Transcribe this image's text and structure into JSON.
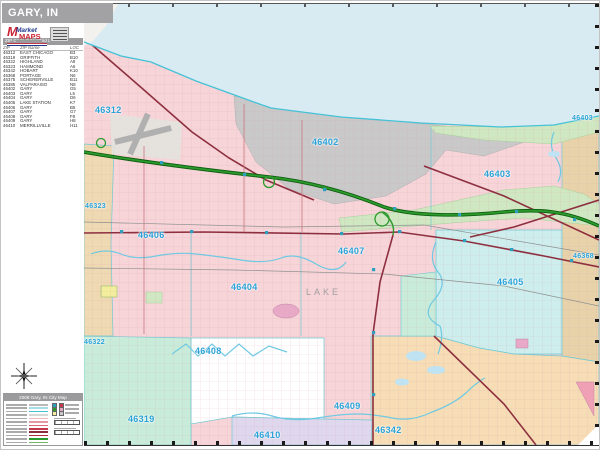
{
  "window": {
    "title": "GARY, IN"
  },
  "logo": {
    "brand_m": "M",
    "brand_top": "Market",
    "brand_bottom": "MAPS"
  },
  "index_table": {
    "header": "ZIP Code Index/Grid Locator",
    "columns": [
      "ZIP Code",
      "ZIP Name",
      "LOC"
    ],
    "rows": [
      [
        "46312",
        "EAST CHICAGO",
        "B3"
      ],
      [
        "46319",
        "GRIFFITH",
        "B10"
      ],
      [
        "46322",
        "HIGHLAND",
        "A8"
      ],
      [
        "46323",
        "HAMMOND",
        "A6"
      ],
      [
        "46342",
        "HOBART",
        "K10"
      ],
      [
        "46368",
        "PORTAGE",
        "N6"
      ],
      [
        "46375",
        "SCHERERVILLE",
        "B11"
      ],
      [
        "46385",
        "VALPARAISO",
        "N8"
      ],
      [
        "46402",
        "GARY",
        "G5"
      ],
      [
        "46403",
        "GARY",
        "L5"
      ],
      [
        "46404",
        "GARY",
        "D6"
      ],
      [
        "46405",
        "LAKE STATION",
        "K7"
      ],
      [
        "46406",
        "GARY",
        "B5"
      ],
      [
        "46407",
        "GARY",
        "G7"
      ],
      [
        "46408",
        "GARY",
        "F8"
      ],
      [
        "46409",
        "GARY",
        "H8"
      ],
      [
        "46410",
        "MERRILLVILLE",
        "H11"
      ]
    ]
  },
  "legend": {
    "title": "2008 Gary, IN City Map",
    "sample_colors": [
      "#b9b9b9",
      "#a6dde8",
      "#49c3d4",
      "#d8d8d8",
      "#f0b8c0",
      "#e59aa6",
      "#d96d7a",
      "#c23a4a",
      "#8e2f3f",
      "#b03040",
      "#2c9b2c",
      "#77b56a"
    ]
  },
  "map": {
    "county_label": "LAKE",
    "label_color": "#2aa2d8",
    "zip_labels": [
      {
        "text": "46312",
        "x": 11,
        "y": 101,
        "size": "lg"
      },
      {
        "text": "46402",
        "x": 228,
        "y": 133,
        "size": "lg"
      },
      {
        "text": "46403",
        "x": 400,
        "y": 165,
        "size": "lg"
      },
      {
        "text": "46403",
        "x": 488,
        "y": 111,
        "size": "sm"
      },
      {
        "text": "46406",
        "x": 54,
        "y": 226,
        "size": "lg"
      },
      {
        "text": "46404",
        "x": 147,
        "y": 278,
        "size": "lg"
      },
      {
        "text": "46407",
        "x": 254,
        "y": 242,
        "size": "lg"
      },
      {
        "text": "46405",
        "x": 413,
        "y": 273,
        "size": "lg"
      },
      {
        "text": "46368",
        "x": 489,
        "y": 249,
        "size": "sm"
      },
      {
        "text": "46409",
        "x": 250,
        "y": 397,
        "size": "lg"
      },
      {
        "text": "46408",
        "x": 111,
        "y": 342,
        "size": "lg"
      },
      {
        "text": "46319",
        "x": 44,
        "y": 410,
        "size": "lg"
      },
      {
        "text": "46410",
        "x": 170,
        "y": 426,
        "size": "lg"
      },
      {
        "text": "46342",
        "x": 291,
        "y": 421,
        "size": "lg"
      },
      {
        "text": "46323",
        "x": 1,
        "y": 199,
        "size": "sm"
      },
      {
        "text": "46322",
        "x": 0,
        "y": 335,
        "size": "sm"
      }
    ],
    "colors": {
      "lake": "#d8ebf3",
      "residential": "#f6d4d8",
      "industrial": "#c9c9ca",
      "park": "#cfe8c2",
      "zone_46405": "#cdeeed",
      "zone_46342": "#f6ddb5",
      "zone_46368": "#e8d2aa",
      "zone_46410": "#ded7ee",
      "zone_46319": "#c8ecd9",
      "zone_46408": "#ffffff",
      "zone_hammond": "#eed9b2",
      "interstate": "#2c9b2c",
      "us_highway": "#8e2f3f",
      "water_line": "#6fc9e2",
      "marker": "#2f9fc0"
    }
  }
}
